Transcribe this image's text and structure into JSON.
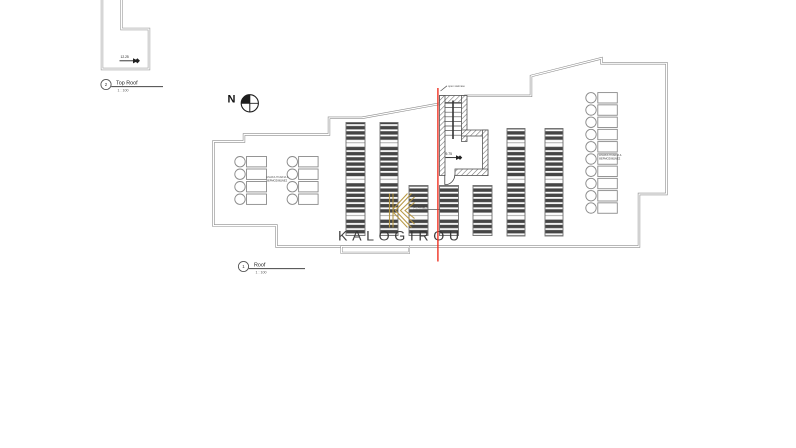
{
  "watermark": {
    "text": "KALOGIROU",
    "text_color": "#44526b",
    "logo_color": "#b5953f"
  },
  "north_arrow": {
    "label": "N"
  },
  "view_titles": {
    "top": {
      "number": "2",
      "title": "Top Roof",
      "scale": "1 : 100"
    },
    "bottom": {
      "number": "1",
      "title": "Roof",
      "scale": "1 : 100"
    }
  },
  "annotations": {
    "top_roof_spot_elevation": "12.25",
    "stair_spot_elevation": "9.75",
    "stair_leader_label": "open staircase",
    "pv_leader_label": "PV PANELS",
    "left_units_label": [
      "ΗΛΙΑΚΑ ΠΛΑΙΣΙΑ &",
      "ΘΕΡΜΟΣΙΦΩΝΕΣ"
    ],
    "right_units_label": [
      "ΗΛΙΑΚΑ ΠΛΑΙΣΙΑ &",
      "ΘΕΡΜΟΣΙΦΩΝΕΣ"
    ]
  },
  "drawing": {
    "outline_color": "#8c8c8c",
    "red_line_color": "#ee2c1c",
    "panel_bar_color": "#454545",
    "panel_strips": [
      {
        "x": 346,
        "y": 122.5,
        "w": 19,
        "h": 113
      },
      {
        "x": 380,
        "y": 122.5,
        "w": 18,
        "h": 113
      },
      {
        "x": 507,
        "y": 128.5,
        "w": 18,
        "h": 107.5
      },
      {
        "x": 545,
        "y": 128.5,
        "w": 18,
        "h": 107.5
      },
      {
        "x": 409,
        "y": 185.5,
        "w": 19,
        "h": 50
      },
      {
        "x": 439.5,
        "y": 185.5,
        "w": 19,
        "h": 50
      },
      {
        "x": 473,
        "y": 185.5,
        "w": 19,
        "h": 50
      }
    ],
    "left_unit_rows_y": [
      156.5,
      169,
      181.5,
      194
    ],
    "left_unit_groups": [
      {
        "circle_cx": 240,
        "rect_x": 246.5,
        "rect_w": 20
      },
      {
        "circle_cx": 292.3,
        "rect_x": 298.6,
        "rect_w": 19.5
      }
    ],
    "right_units": {
      "count": 10,
      "circle_cx": 591,
      "rect_x": 597.8,
      "rect_w": 19.5,
      "top_y": 92.6,
      "pitch": 12.25
    },
    "unit_circle_r": 5.2,
    "unit_row_h": 10.4
  }
}
